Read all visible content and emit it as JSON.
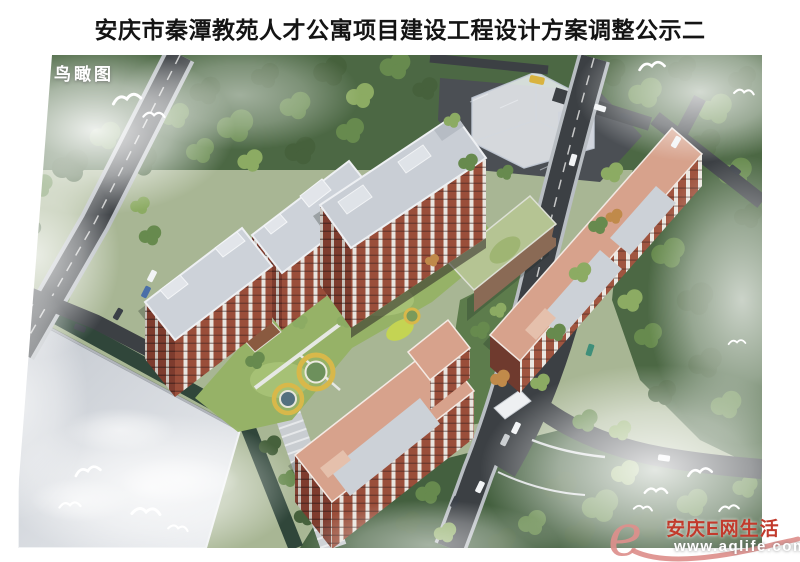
{
  "page": {
    "title": "安庆市秦潭教苑人才公寓项目建设工程设计方案调整公示二"
  },
  "render": {
    "view_label": "鸟瞰图",
    "description": "Aerial bird's-eye architectural rendering of a residential talent-apartment complex with red-brick towers, landscaped courtyard, playground rings, roads with cars, trees, mist and seagulls",
    "palette": {
      "tree_dark": "#46613c",
      "tree_mid": "#678a4e",
      "tree_light": "#8cab63",
      "road": "#3c4044",
      "road_casing": "#b9bec3",
      "brick": "#9a4e3a",
      "roof_grey": "#cdd2d9",
      "roof_salmon": "#d7a28c",
      "lawn": "#96b267",
      "playground_ring": "#d8b84a",
      "pool_teal": "#54707e",
      "mist": "#ffffff"
    }
  },
  "watermark": {
    "logo_glyph": "e",
    "brand": "安庆E网生活",
    "url": "www.aqlife.com",
    "logo_color": "#dd8f8c",
    "brand_color": "#c23a2c",
    "url_color": "#ffffff"
  }
}
